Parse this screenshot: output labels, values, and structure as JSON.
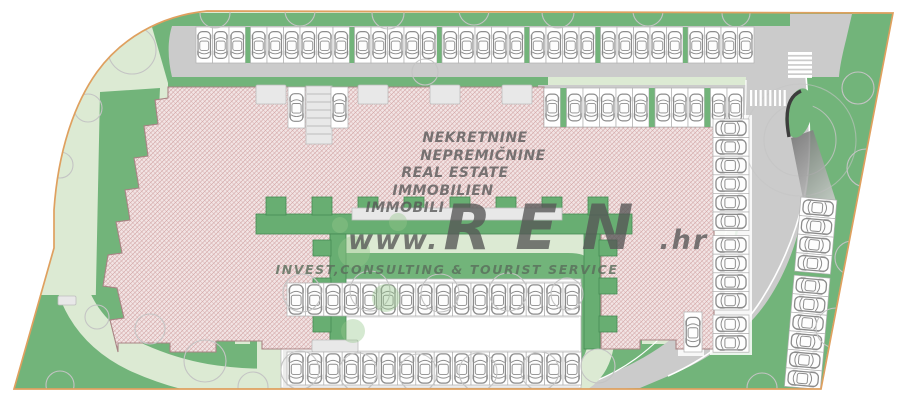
{
  "watermark": {
    "lines": [
      "NEKRETNINE",
      "NEPREMIČNINE",
      "REAL ESTATE",
      "IMMOBILIEN",
      "IMMOBILI"
    ],
    "logo": {
      "prefix": "www.",
      "name": "REN",
      "suffix": ".hr"
    },
    "tagline": "INVEST,CONSULTING & TOURIST SERVICE"
  },
  "colors": {
    "boundary": "#dfa05f",
    "paleGreen": "#dcead3",
    "midGreen": "#72b47a",
    "bandGreen": "#68ae72",
    "road": "#cbcbcb",
    "buildingBase": "#f2e4e4",
    "hatchLine": "#cf9f9f",
    "stall": "#ffffff",
    "car": "#8c8c8c",
    "wmGray": "rgba(86,86,86,0.78)",
    "wmGreen": "rgba(90,110,92,0.82)"
  },
  "plan": {
    "icons": {
      "car": "car-top-view-icon",
      "tree": "tree-canopy-icon",
      "crosswalk": "zebra-crossing-icon",
      "ramp": "garage-ramp-icon"
    },
    "parking": {
      "rows": [
        {
          "name": "north-parking-row",
          "x": 196,
          "y": 27,
          "dir": "h",
          "stallW": 16.5,
          "stallH": 36,
          "groups": [
            3,
            6,
            5,
            5,
            4,
            5,
            4
          ],
          "gap": 5,
          "divider": "green",
          "car": "v"
        },
        {
          "name": "inner-north-parking-row",
          "x": 544,
          "y": 88,
          "dir": "h",
          "stallW": 16.5,
          "stallH": 39,
          "groups": [
            1,
            5,
            3,
            2
          ],
          "gap": 6,
          "divider": "green",
          "car": "v"
        },
        {
          "name": "courtyard-north-parking-row",
          "x": 287,
          "y": 283,
          "dir": "h",
          "stallW": 18.4,
          "stallH": 33,
          "groups": [
            16
          ],
          "gap": 0,
          "divider": "none",
          "car": "v"
        },
        {
          "name": "courtyard-south-parking-row",
          "x": 287,
          "y": 352,
          "dir": "h",
          "stallW": 18.4,
          "stallH": 33,
          "groups": [
            16
          ],
          "gap": 0,
          "divider": "none",
          "car": "v"
        },
        {
          "name": "east-building-parking-column",
          "x": 713,
          "y": 119,
          "dir": "v",
          "stallW": 36,
          "stallH": 18.6,
          "groups": [
            6,
            4,
            2
          ],
          "gap": 5,
          "divider": "none",
          "car": "h"
        },
        {
          "name": "far-east-parking-column",
          "x": 801,
          "y": 197,
          "dir": "v",
          "stallW": 36,
          "stallH": 18.6,
          "groups": [
            4,
            6
          ],
          "gap": 4,
          "divider": "none",
          "car": "h",
          "rot": 5
        },
        {
          "name": "ramp-side-stall-west",
          "x": 288,
          "y": 87,
          "dir": "h",
          "stallW": 17,
          "stallH": 41,
          "groups": [
            1
          ],
          "gap": 0,
          "divider": "none",
          "car": "v"
        },
        {
          "name": "ramp-side-stall-east",
          "x": 331,
          "y": 87,
          "dir": "h",
          "stallW": 17,
          "stallH": 41,
          "groups": [
            1
          ],
          "gap": 0,
          "divider": "none",
          "car": "v"
        },
        {
          "name": "southeast-corner-stall",
          "x": 684,
          "y": 312,
          "dir": "h",
          "stallW": 18,
          "stallH": 40,
          "groups": [
            1
          ],
          "gap": 0,
          "divider": "none",
          "car": "v"
        }
      ]
    }
  }
}
